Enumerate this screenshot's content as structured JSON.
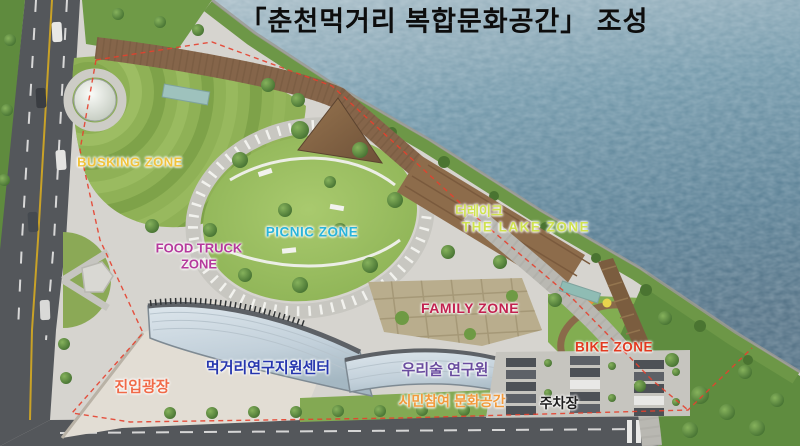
{
  "title": "「춘천먹거리 복합문화공간」 조성",
  "zones": {
    "busking": {
      "label": "BUSKING ZONE",
      "color": "#f0c23c"
    },
    "food_truck": {
      "label": "FOOD TRUCK ZONE",
      "color": "#b5399c"
    },
    "picnic": {
      "label": "PICNIC ZONE",
      "color": "#2ab4da"
    },
    "the_lake": {
      "label_ko": "더레이크",
      "label_en": "THE LAKE ZONE",
      "color": "#cfe24f"
    },
    "family": {
      "label": "FAMILY ZONE",
      "color": "#c22250"
    },
    "bike": {
      "label": "BIKE ZONE",
      "color": "#e23a20"
    }
  },
  "facilities": {
    "entry_plaza": {
      "label": "진입광장",
      "color": "#f06a48"
    },
    "food_research_center": {
      "label": "먹거리연구지원센터",
      "color": "#2636ae"
    },
    "liquor_institute": {
      "label": "우리술 연구원",
      "color": "#6a4d9f"
    },
    "citizen_culture_space": {
      "label": "시민참여 문화공간",
      "color": "#f29a3c"
    },
    "parking": {
      "label": "주차장",
      "color": "#1c1c1c"
    }
  },
  "palette": {
    "water": "#5d8196",
    "grass": "#8fb156",
    "boardwalk": "#85654a",
    "road": "#54575b",
    "paving": "#d6d4cf",
    "boundary_line": "#e6402e"
  }
}
